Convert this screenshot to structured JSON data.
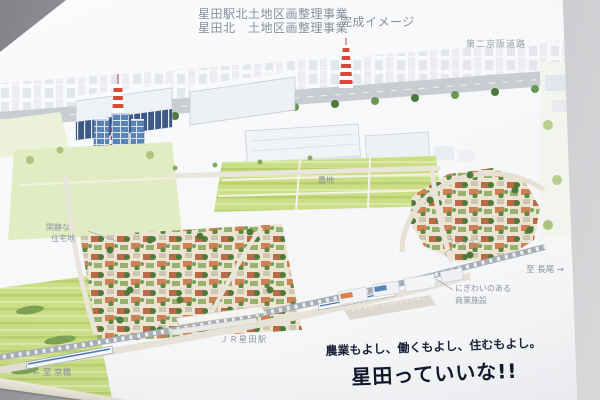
{
  "board": {
    "title": {
      "line1": "星田駅北土地区画整理事業",
      "line2": "星田北　土地区画整理事業",
      "suffix": "完成イメージ"
    },
    "labels": {
      "highway": "第二京阪道路",
      "quiet_residential_1": "閑静な",
      "quiet_residential_2": "住宅地",
      "farmland": "農地",
      "apartment": "マンション",
      "commercial_1": "にぎわいのある",
      "commercial_2": "商業施設",
      "station": "ＪＲ星田駅",
      "to_kyobashi": "← 至 京橋",
      "to_nagao": "至 長尾 →"
    },
    "slogan": {
      "line1": "農業もよし、働くもよし、住むもよし。",
      "line2": "星田っていいな!!"
    }
  },
  "colors": {
    "wall_gray": "#a8a9ad",
    "board_white": "#f7f8f9",
    "title_gray": "#8a8f9e",
    "label_gray": "#8d93a1",
    "slogan_navy": "#10152a",
    "field_green": "#cbdd86",
    "tree_green": "#4d7a3b",
    "roof_orange": "#d08055",
    "building_blue": "#5b84b4",
    "tower_red": "#d84a38",
    "road_beige": "#e9e5da",
    "rail_gray": "#a7adb6"
  }
}
